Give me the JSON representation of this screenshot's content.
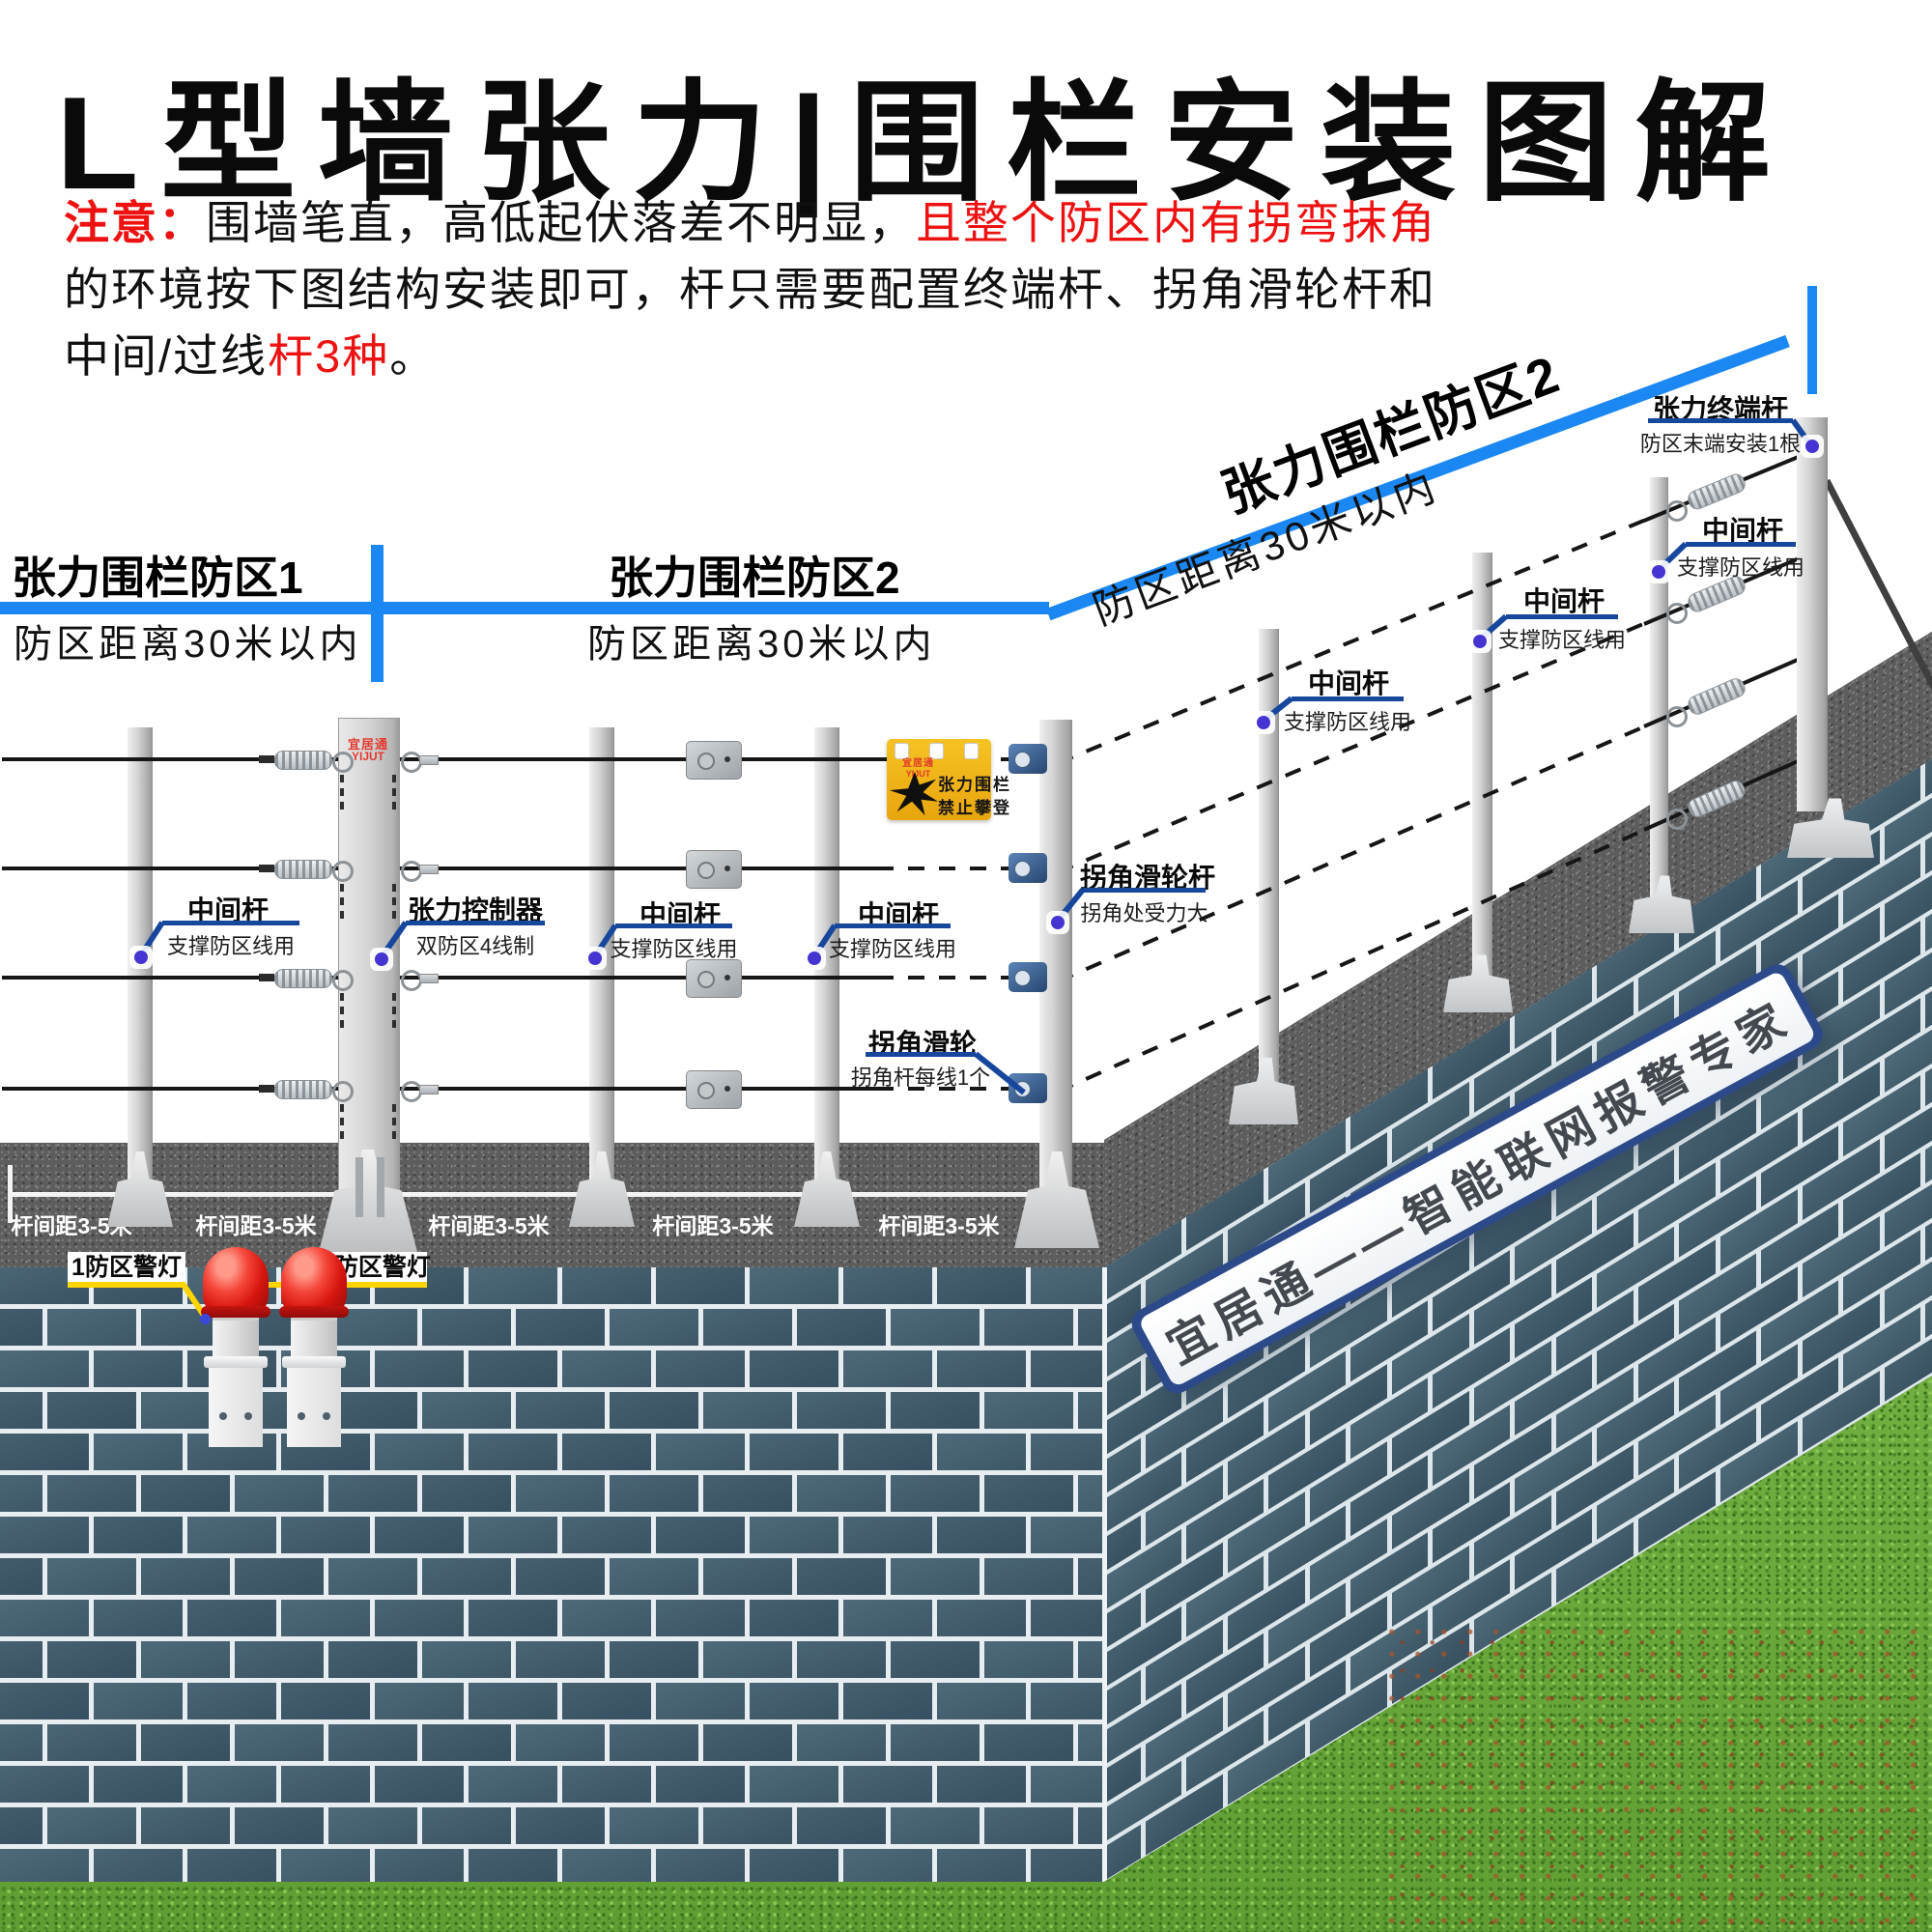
{
  "page": {
    "title": "L型墙张力|围栏安装图解"
  },
  "notice": {
    "prefix": "注意：",
    "line1_black": "围墙笔直，高低起伏落差不明显，",
    "line1_red": "且整个防区内有拐弯抹角",
    "line2": "的环境按下图结构安装即可，杆只需要配置终端杆、拐角滑轮杆和",
    "line3_black": "中间/过线",
    "line3_red": "杆3种",
    "line3_tail": "。"
  },
  "zones": {
    "zone1_title": "张力围栏防区1",
    "zone1_sub": "防区距离30米以内",
    "zone2_title": "张力围栏防区2",
    "zone2_sub": "防区距离30米以内",
    "zone2_slope_title": "张力围栏防区2",
    "zone2_slope_sub": "防区距离30米以内"
  },
  "callouts": [
    {
      "id": "mid-pole-1",
      "title": "中间杆",
      "subtitle": "支撑防区线用"
    },
    {
      "id": "tension-controller",
      "title": "张力控制器",
      "subtitle": "双防区4线制"
    },
    {
      "id": "mid-pole-2",
      "title": "中间杆",
      "subtitle": "支撑防区线用"
    },
    {
      "id": "mid-pole-3",
      "title": "中间杆",
      "subtitle": "支撑防区线用"
    },
    {
      "id": "corner-pulley-pole",
      "title": "拐角滑轮杆",
      "subtitle": "拐角处受力大"
    },
    {
      "id": "corner-pulley",
      "title": "拐角滑轮",
      "subtitle": "拐角杆每线1个"
    },
    {
      "id": "slope-mid-pole-1",
      "title": "中间杆",
      "subtitle": "支撑防区线用"
    },
    {
      "id": "slope-mid-pole-2",
      "title": "中间杆",
      "subtitle": "支撑防区线用"
    },
    {
      "id": "slope-mid-pole-3",
      "title": "中间杆",
      "subtitle": "支撑防区线用"
    },
    {
      "id": "terminal-pole",
      "title": "张力终端杆",
      "subtitle": "防区末端安装1根"
    }
  ],
  "spacing_labels": [
    "杆间距3-5米",
    "杆间距3-5米",
    "杆间距3-5米",
    "杆间距3-5米",
    "杆间距3-5米"
  ],
  "alarm": {
    "label_zone1": "1防区警灯",
    "label_zone2": "2防区警灯"
  },
  "warning_sign": {
    "brand_cn": "宜居通",
    "brand_en": "YIJUT",
    "line1": "张力围栏",
    "line2": "禁止攀登"
  },
  "controller_badge": {
    "brand_cn": "宜居通",
    "brand_en": "YIJUT"
  },
  "wall_banner": {
    "text": "宜居通——智能联网报警专家"
  },
  "colors": {
    "accent_blue": "#1b87f2",
    "callout_navy": "#17479d",
    "dot_blue": "#4634d2",
    "alarm_yellow": "#ffd400",
    "notice_red": "#ee1111",
    "sign_yellow": "#f2b714",
    "brick": "#415c6c",
    "grass": "#69a83c",
    "road": "#5d5d5d"
  }
}
